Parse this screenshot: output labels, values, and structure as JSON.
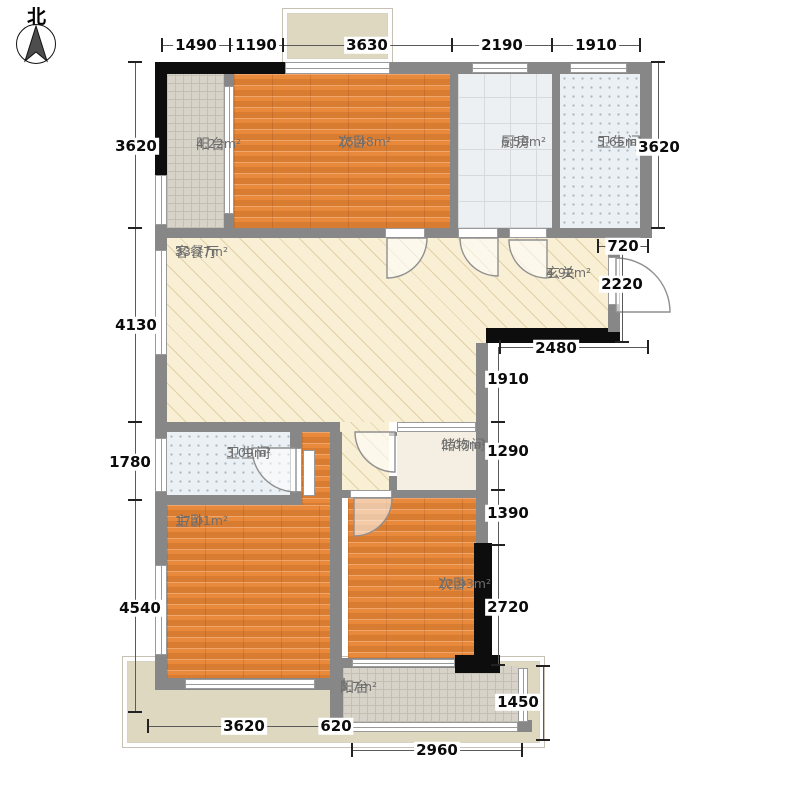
{
  "compass": {
    "north_label": "北"
  },
  "rooms": [
    {
      "id": "balcony-top",
      "name": "阳台",
      "area": "4.22m²"
    },
    {
      "id": "bedroom-top",
      "name": "次卧",
      "area": "15.48m²"
    },
    {
      "id": "kitchen",
      "name": "厨房",
      "area": "6.59m²"
    },
    {
      "id": "bath-top",
      "name": "卫生间",
      "area": "5.65m²"
    },
    {
      "id": "living-dining",
      "name": "客餐厅",
      "area": "33.77m²"
    },
    {
      "id": "foyer",
      "name": "玄关",
      "area": "4.92m²"
    },
    {
      "id": "bath-mid",
      "name": "卫生间",
      "area": "3.09m²"
    },
    {
      "id": "storage",
      "name": "储物间",
      "area": "2.05m²"
    },
    {
      "id": "master-bedroom",
      "name": "主卧",
      "area": "17.01m²"
    },
    {
      "id": "bedroom-bottom",
      "name": "次卧",
      "area": "12.93m²"
    },
    {
      "id": "balcony-bottom",
      "name": "阳台",
      "area": "3.7m²"
    }
  ],
  "dims": {
    "top": [
      "1490",
      "1190",
      "3630",
      "2190",
      "1910"
    ],
    "left": [
      "3620",
      "4130",
      "1780",
      "4540"
    ],
    "right": [
      "3620",
      "720",
      "2220",
      "2480",
      "1910",
      "1290",
      "1390",
      "2720",
      "1450"
    ],
    "bottom": [
      "3620",
      "620",
      "2960"
    ]
  },
  "colors": {
    "wall": "#878787",
    "load_bearing_wall": "#0d0d0d",
    "wood_floor": "#e8893c",
    "living_hatch": "#f8efd4",
    "kitchen_tile": "#edf0f2",
    "bath_tile": "#eaf0f4",
    "balcony_tile": "#d8d3c8",
    "patio": "#ded8c1"
  }
}
